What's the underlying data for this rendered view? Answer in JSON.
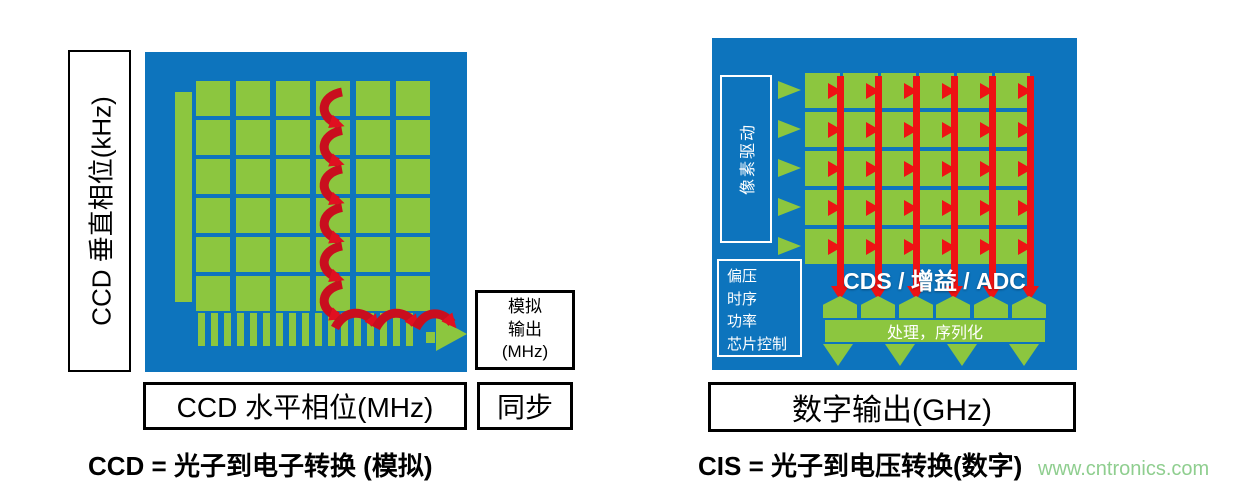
{
  "colors": {
    "panel_blue": "#0D74BD",
    "pixel_green": "#8CC63F",
    "arrow_red": "#EE1214",
    "curve_red": "#C90E1E",
    "watermark_green": "#8FCE8F"
  },
  "ccd": {
    "vertical_axis_label": "CCD 垂直相位(kHz)",
    "horizontal_axis_label": "CCD 水平相位(MHz)",
    "sync_label": "同步",
    "analog_output_lines": [
      "模拟",
      "输出",
      "(MHz)"
    ],
    "caption": "CCD = 光子到电子转换 (模拟)",
    "grid_rows": 6,
    "grid_cols": 6,
    "register_stripes": 17
  },
  "cis": {
    "pixel_drive_label": "像素驱动",
    "control_lines": [
      "偏压",
      "时序",
      "功率",
      "芯片控制"
    ],
    "cds_gain_adc_label": "CDS / 增益 / ADC",
    "processing_label": "处理，序列化",
    "digital_output_label": "数字输出(GHz)",
    "caption": "CIS = 光子到电压转换(数字)",
    "grid_rows": 5,
    "grid_cols": 6,
    "row_drivers": 5,
    "column_readout_lines": 6,
    "adc_blocks": 6,
    "output_arrows": 4
  },
  "watermark": "www.cntronics.com"
}
